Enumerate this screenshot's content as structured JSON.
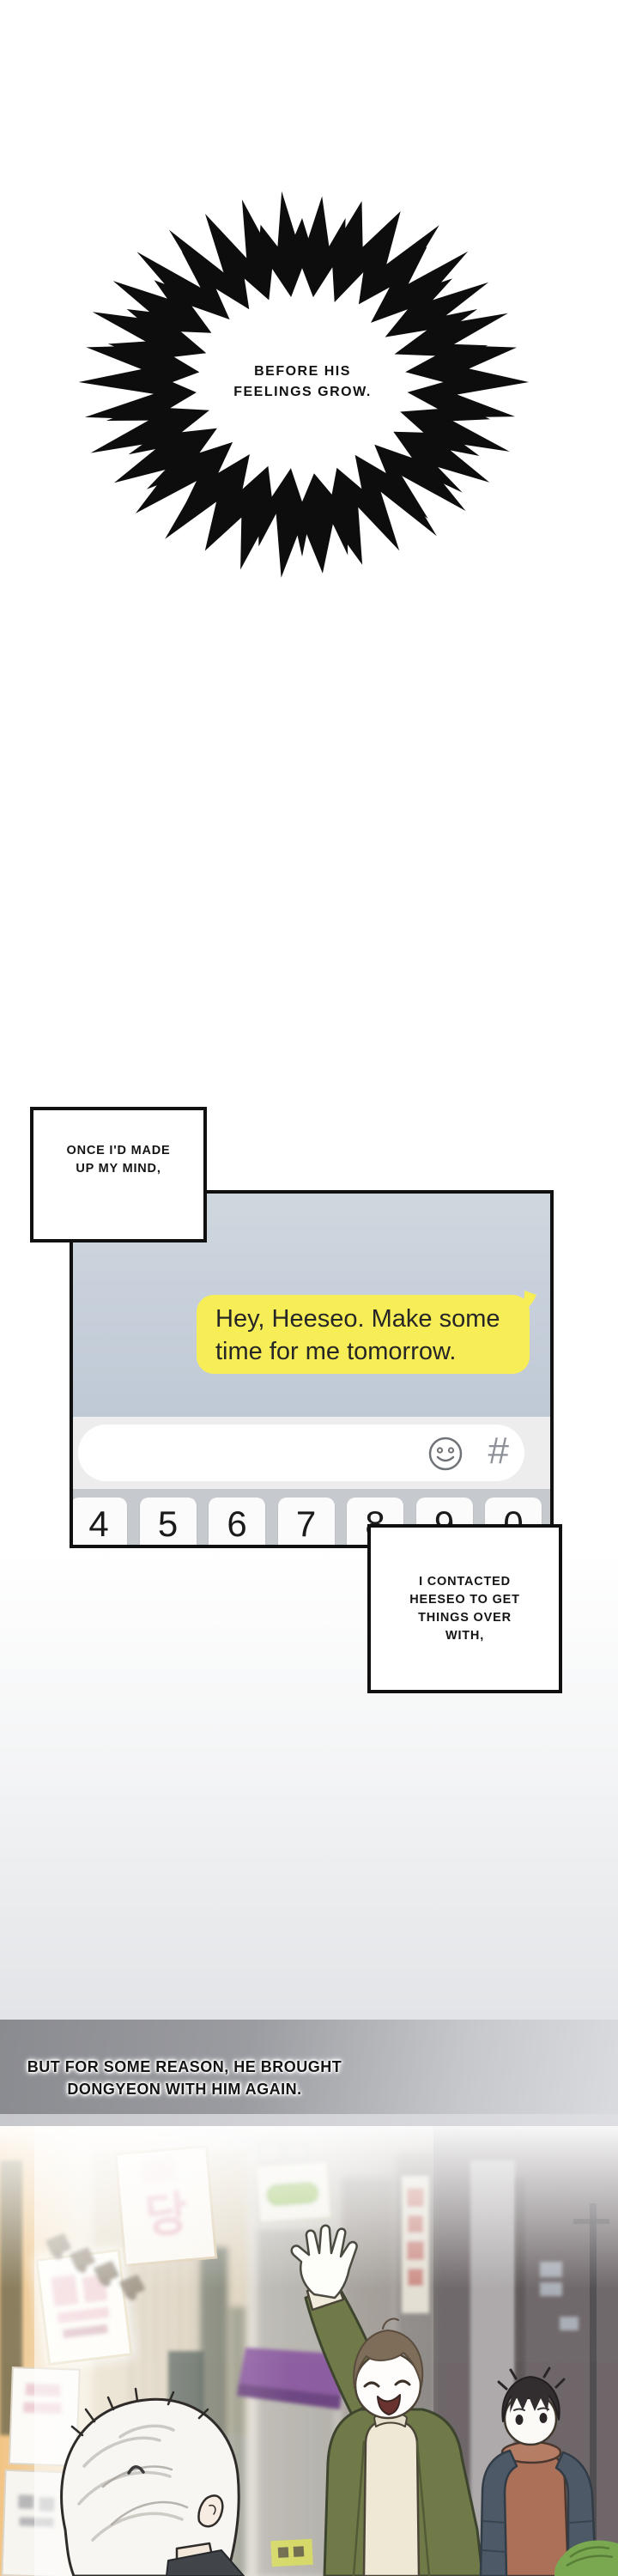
{
  "burst": {
    "line1": "BEFORE HIS",
    "line2": "FEELINGS GROW."
  },
  "caption_decided": {
    "line1": "ONCE I'D MADE",
    "line2": "UP MY MIND,"
  },
  "phone": {
    "message": {
      "line1": "Hey, Heeseo. Make some",
      "line2": "time for me tomorrow."
    },
    "composer": {
      "input_value": "",
      "hash_icon": "#"
    },
    "keyboard": {
      "keys": [
        "4",
        "5",
        "6",
        "7",
        "8",
        "9",
        "0"
      ]
    }
  },
  "caption_contacted": {
    "line1": "I CONTACTED",
    "line2": "HEESEO TO GET",
    "line3": "THINGS OVER",
    "line4": "WITH,"
  },
  "narration": {
    "line1": "BUT FOR SOME REASON, HE BROUGHT",
    "line2": "DONGYEON WITH HIM AGAIN."
  },
  "scene": {
    "sign_dang": "당"
  },
  "colors": {
    "bubble_yellow": "#f7ee57",
    "chat_background": "#c6cfda",
    "keyboard_gray": "#c6c9ce",
    "band_gray_left": "#8a8b90",
    "band_gray_right": "#d9dbde",
    "coat_olive": "#707a49",
    "hoodie_rust": "#ab7058",
    "jacket_slate": "#4d5967",
    "awning_purple": "#8a58a0",
    "sign_pink_text": "#e29fb1"
  }
}
